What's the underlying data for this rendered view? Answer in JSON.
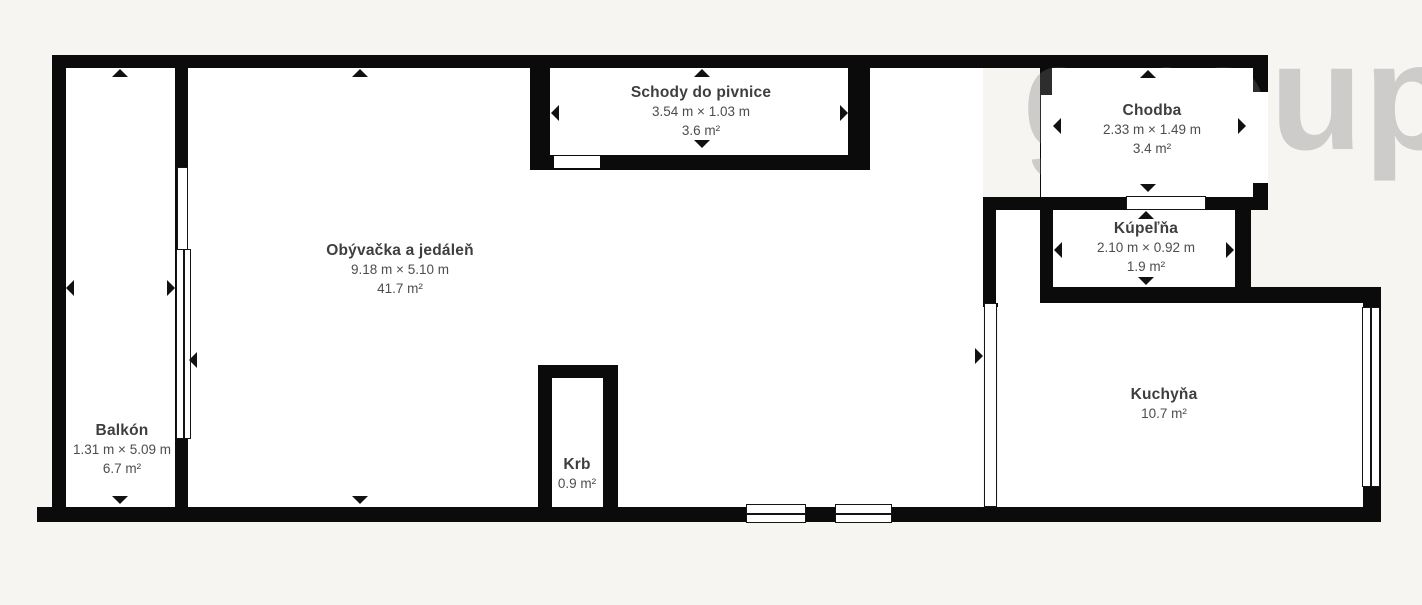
{
  "colors": {
    "wall": "#0b0b0b",
    "background": "#f7f5f2",
    "room_fill": "#ffffff",
    "label_text": "#3e3e3e",
    "dims_text": "#4d4d4d"
  },
  "watermark": {
    "text": "group"
  },
  "rooms": {
    "balkon": {
      "name": "Balkón",
      "dims": "1.31 m × 5.09 m",
      "area": "6.7 m²"
    },
    "obyvacka": {
      "name": "Obývačka a jedáleň",
      "dims": "9.18 m × 5.10 m",
      "area": "41.7 m²"
    },
    "schody": {
      "name": "Schody do pivnice",
      "dims": "3.54 m × 1.03 m",
      "area": "3.6 m²"
    },
    "chodba": {
      "name": "Chodba",
      "dims": "2.33 m × 1.49 m",
      "area": "3.4 m²"
    },
    "kupelna": {
      "name": "Kúpeľňa",
      "dims": "2.10 m × 0.92 m",
      "area": "1.9 m²"
    },
    "krb": {
      "name": "Krb",
      "area": "0.9 m²"
    },
    "kuchyna": {
      "name": "Kuchyňa",
      "area": "10.7 m²"
    }
  }
}
